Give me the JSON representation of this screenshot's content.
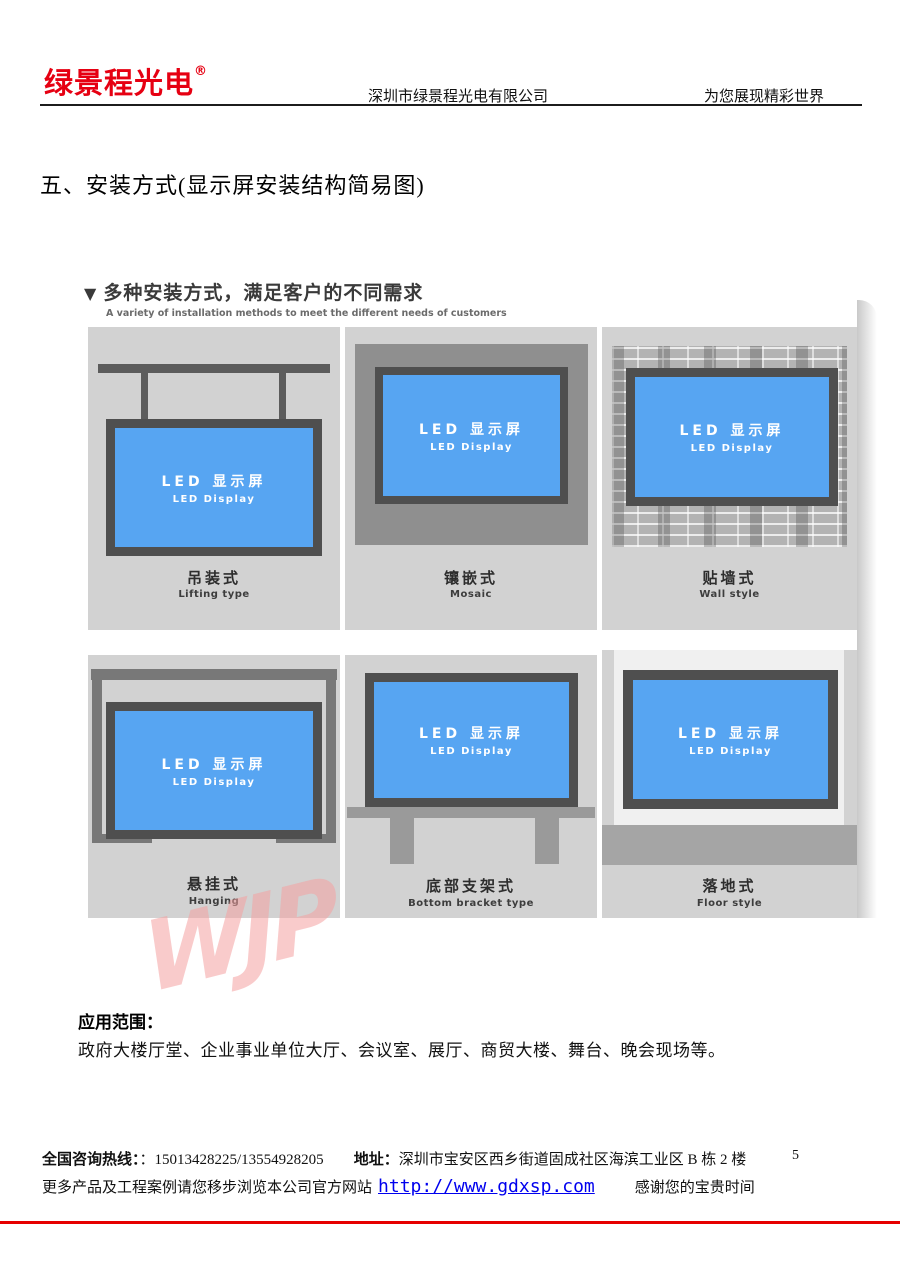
{
  "header": {
    "logo": "绿景程光电",
    "registered_mark": "®",
    "company": "深圳市绿景程光电有限公司",
    "slogan": "为您展现精彩世界"
  },
  "section_title": "五、安装方式(显示屏安装结构简易图)",
  "panel": {
    "marker": "▼",
    "heading": "多种安装方式，满足客户的不同需求",
    "subheading": "A variety of installation methods to meet the different needs of customers",
    "display_label_cn": "LED 显示屏",
    "display_label_en": "LED Display",
    "methods": [
      {
        "cn": "吊装式",
        "en": "Lifting type"
      },
      {
        "cn": "镶嵌式",
        "en": "Mosaic"
      },
      {
        "cn": "贴墙式",
        "en": "Wall style"
      },
      {
        "cn": "悬挂式",
        "en": "Hanging"
      },
      {
        "cn": "底部支架式",
        "en": "Bottom bracket type"
      },
      {
        "cn": "落地式",
        "en": "Floor style"
      }
    ],
    "watermark": "WJP"
  },
  "application": {
    "label": "应用范围：",
    "text": "政府大楼厅堂、企业事业单位大厅、会议室、展厅、商贸大楼、舞台、晚会现场等。"
  },
  "footer": {
    "hotline_label": "全国咨询热线：",
    "hotline_value": "：15013428225/13554928205",
    "address_label": "地址：",
    "address_value": "深圳市宝安区西乡街道固成社区海滨工业区 B 栋 2 楼",
    "page_number": "5",
    "more_text": "更多产品及工程案例请您移步浏览本公司官方网站",
    "website": "http://www.gdxsp.com",
    "thanks": "感谢您的宝贵时间"
  },
  "colors": {
    "brand_red": "#e60012",
    "screen_blue": "#57a5f2",
    "frame_dark": "#4f4f4f",
    "panel_gray": "#d2d2d2",
    "link_blue": "#0000ee",
    "bottom_rule_red": "#e60000"
  }
}
